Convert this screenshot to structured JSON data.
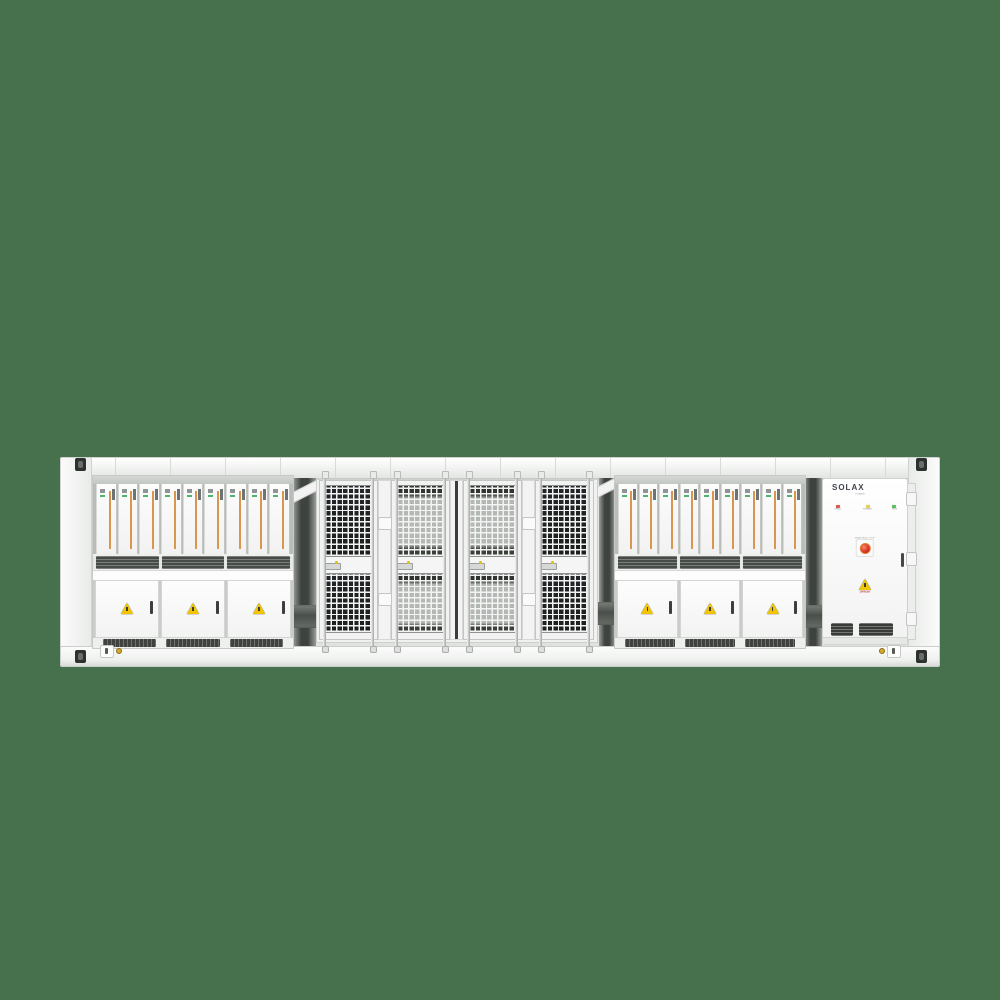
{
  "scene": {
    "background_color": "#47714d",
    "subject": "Containerized battery energy storage system, front view"
  },
  "racks": {
    "pcs_label": "PCS Distribution Cabinet",
    "modules_per_rack": 9,
    "doors_per_rack": 3,
    "fan_segments": 3,
    "vent_segments": 3,
    "module_stripe_color": "#d9964f"
  },
  "cage": {
    "door_count": 4
  },
  "solax": {
    "brand": "SOLAX",
    "brand_sub": "POWER",
    "leds": [
      {
        "label": "FAULT",
        "color": "#e0524a"
      },
      {
        "label": "POWER",
        "color": "#e5d44b"
      },
      {
        "label": "RUN",
        "color": "#57c05a"
      }
    ],
    "estop_label": "EMERGENCY STOP",
    "warning_label": "DANGER"
  },
  "colors": {
    "container_body": "#f3f4f3",
    "warning_yellow": "#f2c500",
    "mesh_dark": "#1e221e"
  }
}
